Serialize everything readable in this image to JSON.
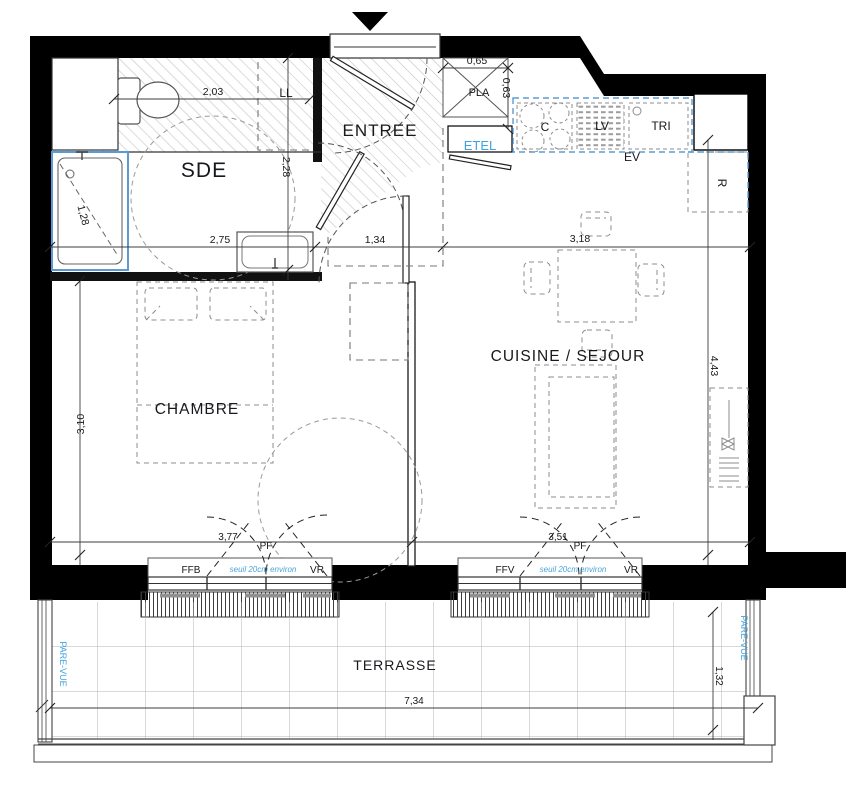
{
  "colors": {
    "accent_blue": "#3fa2dc",
    "fixture_blue": "#5b9bd5",
    "wall_black": "#000000",
    "hatch_gray": "#c4c4c4"
  },
  "rooms": {
    "sde": "SDE",
    "entree": "ENTREE",
    "cuisine_sejour": "CUISINE / SEJOUR",
    "chambre": "CHAMBRE",
    "terrasse": "TERRASSE"
  },
  "equipment": {
    "washer": "LL",
    "closet": "PLA",
    "electrical": "ETEL",
    "hob": "C",
    "dishwasher": "LV",
    "waste": "TRI",
    "sink": "EV",
    "fridge": "R"
  },
  "windows": {
    "left": {
      "fixed": "FFB",
      "shutter": "VR",
      "door": "PF",
      "threshold": "seuil 20cm environ",
      "width": "3,77"
    },
    "right": {
      "fixed": "FFV",
      "shutter": "VR",
      "door": "PF",
      "threshold": "seuil 20cm environ",
      "width": "3,51"
    }
  },
  "screens": {
    "left": "PARE-VUE",
    "right": "PARE-VUE"
  },
  "dims": {
    "wc_width": "2,03",
    "pla_width": "0,65",
    "pla_depth": "0,63",
    "sde_depth": "2,28",
    "sde_width": "2,75",
    "hall_width": "1,34",
    "kitchen_width": "3,18",
    "shower_length": "1,28",
    "chambre_depth": "3,10",
    "sejour_depth": "4,43",
    "terrace_width": "7,34",
    "terrace_depth": "1,32"
  }
}
